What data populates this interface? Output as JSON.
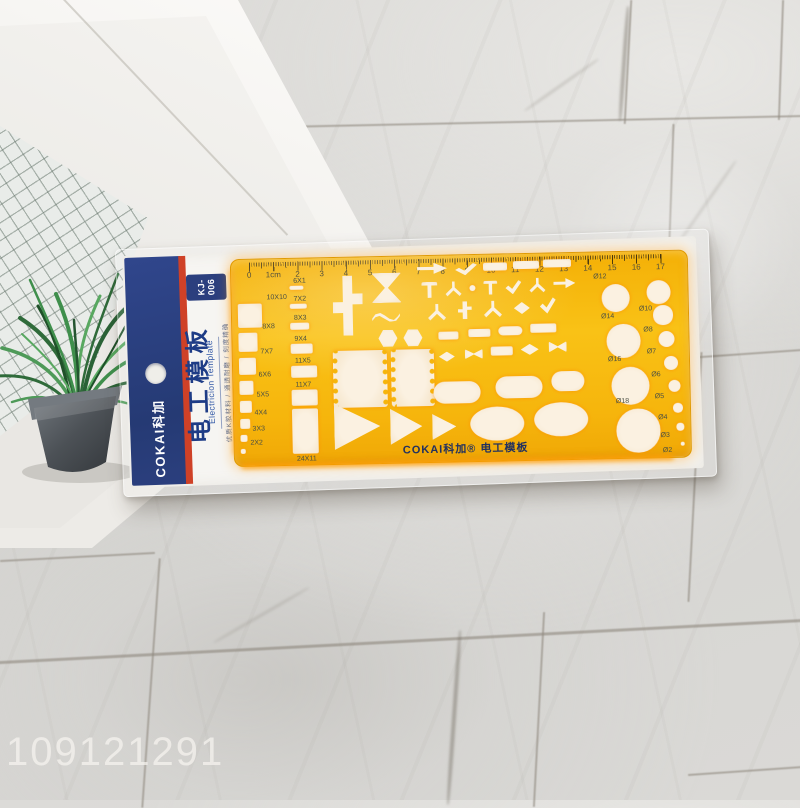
{
  "watermark": "109121291",
  "package": {
    "brand": "COKAI科加",
    "model_line1": "KJ-",
    "model_line2": "006",
    "title_cn": "电工模板",
    "title_en": "Electricion Template",
    "subtitle": "优质K胶材料 / 通透耐磨 / 刻度精确"
  },
  "template": {
    "footer": "COKAI科加® 电工模板",
    "ruler_numbers": [
      "0",
      "1cm",
      "2",
      "3",
      "4",
      "5",
      "6",
      "7",
      "8",
      "9",
      "10",
      "11",
      "12",
      "13",
      "14",
      "15",
      "16",
      "17"
    ],
    "squares": [
      "10X10",
      "8X8",
      "7X7",
      "6X6",
      "5X5",
      "4X4",
      "3X3",
      "2X2"
    ],
    "slots": [
      "6X1",
      "7X2",
      "8X3",
      "9X4",
      "11X5",
      "11X7",
      "24X11"
    ],
    "circles_large": [
      "Ø12",
      "Ø14",
      "Ø16",
      "Ø18"
    ],
    "circles_small": [
      "Ø10",
      "Ø8",
      "Ø7",
      "Ø6",
      "Ø5",
      "Ø4",
      "Ø3",
      "Ø2"
    ],
    "symbols": [
      {
        "t": "cross",
        "x": 101,
        "y": 18,
        "w": 30,
        "h": 60
      },
      {
        "t": "bowtie",
        "x": 140,
        "y": 16,
        "w": 30,
        "h": 30
      },
      {
        "t": "wave",
        "x": 140,
        "y": 54,
        "w": 28,
        "h": 11
      },
      {
        "t": "hex",
        "x": 146,
        "y": 73,
        "w": 19,
        "h": 17
      },
      {
        "t": "hex",
        "x": 171,
        "y": 73,
        "w": 19,
        "h": 17
      },
      {
        "t": "coil",
        "x": 100,
        "y": 93,
        "w": 44,
        "h": 57
      },
      {
        "t": "coil",
        "x": 158,
        "y": 93,
        "w": 33,
        "h": 57
      },
      {
        "t": "arrow",
        "x": 186,
        "y": 6,
        "w": 30,
        "h": 13
      },
      {
        "t": "angle",
        "x": 224,
        "y": 8,
        "w": 22,
        "h": 12
      },
      {
        "t": "bar",
        "x": 252,
        "y": 8,
        "w": 24,
        "h": 8
      },
      {
        "t": "bar",
        "x": 282,
        "y": 7,
        "w": 26,
        "h": 8
      },
      {
        "t": "bar",
        "x": 312,
        "y": 6,
        "w": 28,
        "h": 8
      },
      {
        "t": "tee",
        "x": 190,
        "y": 26,
        "w": 16,
        "h": 16
      },
      {
        "t": "ybranch",
        "x": 214,
        "y": 26,
        "w": 16,
        "h": 16
      },
      {
        "t": "dot",
        "x": 238,
        "y": 30,
        "w": 6,
        "h": 6
      },
      {
        "t": "tee",
        "x": 252,
        "y": 26,
        "w": 14,
        "h": 14
      },
      {
        "t": "angle",
        "x": 274,
        "y": 26,
        "w": 16,
        "h": 14
      },
      {
        "t": "ybranch",
        "x": 298,
        "y": 24,
        "w": 16,
        "h": 16
      },
      {
        "t": "arrow",
        "x": 322,
        "y": 24,
        "w": 22,
        "h": 12
      },
      {
        "t": "ybranch",
        "x": 196,
        "y": 48,
        "w": 18,
        "h": 18
      },
      {
        "t": "cross",
        "x": 226,
        "y": 46,
        "w": 14,
        "h": 18
      },
      {
        "t": "ybranch",
        "x": 252,
        "y": 46,
        "w": 18,
        "h": 18
      },
      {
        "t": "diamond",
        "x": 282,
        "y": 48,
        "w": 16,
        "h": 12
      },
      {
        "t": "angle",
        "x": 308,
        "y": 44,
        "w": 16,
        "h": 16
      },
      {
        "t": "bar",
        "x": 206,
        "y": 76,
        "w": 20,
        "h": 8
      },
      {
        "t": "bar",
        "x": 236,
        "y": 74,
        "w": 22,
        "h": 8
      },
      {
        "t": "capsule",
        "x": 266,
        "y": 72,
        "w": 24,
        "h": 9
      },
      {
        "t": "bar",
        "x": 298,
        "y": 70,
        "w": 26,
        "h": 9
      },
      {
        "t": "diamond",
        "x": 206,
        "y": 96,
        "w": 16,
        "h": 10
      },
      {
        "t": "bowtie2",
        "x": 232,
        "y": 94,
        "w": 18,
        "h": 10
      },
      {
        "t": "bar",
        "x": 258,
        "y": 92,
        "w": 22,
        "h": 9
      },
      {
        "t": "diamond",
        "x": 288,
        "y": 90,
        "w": 18,
        "h": 11
      },
      {
        "t": "bowtie2",
        "x": 316,
        "y": 88,
        "w": 18,
        "h": 11
      },
      {
        "t": "capsule",
        "x": 200,
        "y": 126,
        "w": 47,
        "h": 22
      },
      {
        "t": "capsule",
        "x": 262,
        "y": 122,
        "w": 47,
        "h": 22
      },
      {
        "t": "capsule",
        "x": 318,
        "y": 118,
        "w": 33,
        "h": 20
      },
      {
        "t": "oval",
        "x": 236,
        "y": 152,
        "w": 54,
        "h": 34
      },
      {
        "t": "oval",
        "x": 300,
        "y": 149,
        "w": 54,
        "h": 34
      },
      {
        "t": "tri",
        "x": 100,
        "y": 146,
        "w": 46,
        "h": 46
      },
      {
        "t": "tri",
        "x": 156,
        "y": 152,
        "w": 32,
        "h": 36
      },
      {
        "t": "tri",
        "x": 198,
        "y": 158,
        "w": 24,
        "h": 26
      }
    ]
  },
  "colors": {
    "template_yellow": "#f6b50c",
    "glow_orange": "#ff9d00",
    "band_blue": "#2b3f7e",
    "stripe_red": "#cf4127",
    "text_navy": "#22315f"
  }
}
